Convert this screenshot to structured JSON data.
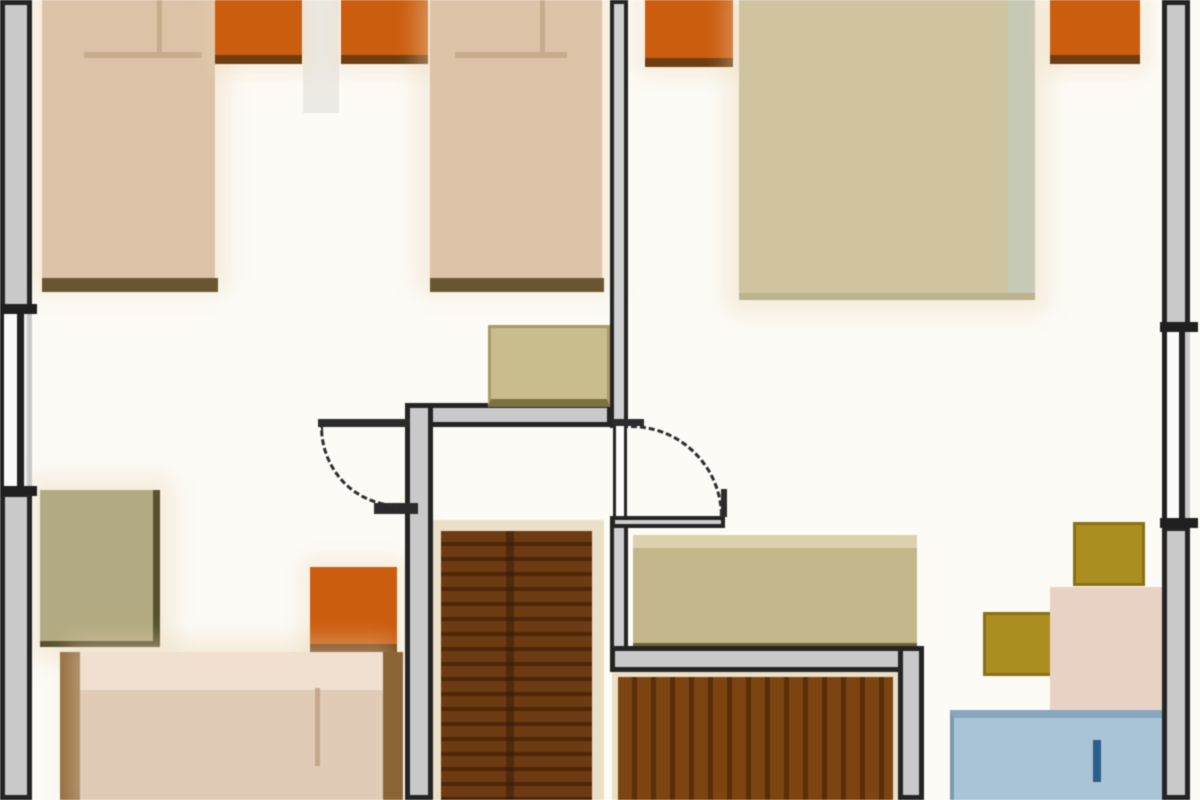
{
  "meta": {
    "diagram_type": "architectural-floor-plan",
    "canvas": {
      "width": 1200,
      "height": 800
    },
    "background": "#fcfbf6"
  },
  "palette": {
    "wall_fill": "#c9c9c9",
    "wall_line": "#242424",
    "bed_tan": "#dcc2a5",
    "bed_foot_brown": "#6a5532",
    "wardrobe_orange": "#cd5d0d",
    "double_bed_khaki": "#cfc39f",
    "stair_brown": "#6e3b11",
    "stair_brown_2": "#7c440f",
    "desk_olive": "#b2aa81",
    "sideboard_khaki": "#c2b689",
    "chair_gold": "#ac8d1e",
    "table_pink": "#e8d2c4",
    "blue_furniture": "#a9c3d8"
  },
  "elements": [
    {
      "name": "room-divider-faint",
      "cls": "faint",
      "rect": [
        303,
        0,
        36,
        113
      ]
    },
    {
      "name": "bed-single-1-mattress",
      "cls": "shadowed",
      "rect": [
        42,
        0,
        173,
        280
      ],
      "color": "#dcc2a5"
    },
    {
      "name": "bed-single-1-footboard",
      "cls": "",
      "rect": [
        42,
        278,
        176,
        14
      ],
      "color": "#6a5532"
    },
    {
      "name": "bed-single-1-pillow-line",
      "cls": "",
      "rect": [
        84,
        52,
        118,
        6
      ],
      "color": "#c7ab8c"
    },
    {
      "name": "bed-single-1-pillow-fold",
      "cls": "",
      "rect": [
        157,
        0,
        5,
        54
      ],
      "color": "#c7ab8c"
    },
    {
      "name": "wardrobe-1",
      "cls": "wardrobe",
      "rect": [
        215,
        0,
        87,
        64
      ]
    },
    {
      "name": "wardrobe-2",
      "cls": "wardrobe",
      "rect": [
        341,
        0,
        87,
        64
      ]
    },
    {
      "name": "bed-single-2-mattress",
      "cls": "shadowed",
      "rect": [
        430,
        0,
        172,
        280
      ],
      "color": "#dcc2a5"
    },
    {
      "name": "bed-single-2-footboard",
      "cls": "",
      "rect": [
        430,
        278,
        174,
        14
      ],
      "color": "#6a5532"
    },
    {
      "name": "bed-single-2-pillow-line",
      "cls": "",
      "rect": [
        455,
        52,
        112,
        6
      ],
      "color": "#c7ab8c"
    },
    {
      "name": "bed-single-2-pillow-fold",
      "cls": "",
      "rect": [
        540,
        0,
        5,
        54
      ],
      "color": "#c7ab8c"
    },
    {
      "name": "wardrobe-3",
      "cls": "wardrobe",
      "rect": [
        645,
        0,
        88,
        67
      ]
    },
    {
      "name": "bed-double",
      "cls": "shadowed bed-double",
      "rect": [
        739,
        0,
        296,
        300
      ],
      "color": "#cfc39f"
    },
    {
      "name": "bed-double-edge",
      "cls": "",
      "rect": [
        1008,
        0,
        27,
        293
      ],
      "color": "#c6c9b6"
    },
    {
      "name": "wardrobe-4",
      "cls": "wardrobe",
      "rect": [
        1050,
        0,
        90,
        64
      ]
    },
    {
      "name": "desk",
      "cls": "desk shadowed",
      "rect": [
        40,
        490,
        120,
        157
      ]
    },
    {
      "name": "cabinet-orange-small",
      "cls": "wardrobe",
      "rect": [
        310,
        567,
        87,
        86
      ]
    },
    {
      "name": "bed-3-rail-left",
      "cls": "",
      "rect": [
        60,
        652,
        20,
        148
      ],
      "color": "#8d6536"
    },
    {
      "name": "bed-3-mattress",
      "cls": "shadowed",
      "rect": [
        80,
        652,
        303,
        148
      ],
      "color": "#e0cbb6"
    },
    {
      "name": "bed-3-pillow-band",
      "cls": "",
      "rect": [
        80,
        652,
        303,
        38
      ],
      "color": "#efe0d0"
    },
    {
      "name": "bed-3-crease",
      "cls": "",
      "rect": [
        315,
        688,
        5,
        78
      ],
      "color": "#c8a78a"
    },
    {
      "name": "bed-3-rail-right",
      "cls": "",
      "rect": [
        383,
        652,
        20,
        148
      ],
      "color": "#8d6536"
    },
    {
      "name": "staircase-1-frame",
      "cls": "stairs-frame",
      "rect": [
        433,
        520,
        171,
        280
      ]
    },
    {
      "name": "staircase-1-treads",
      "cls": "stairs-treads-h",
      "rect": [
        441,
        531,
        151,
        269
      ]
    },
    {
      "name": "staircase-1-stringer",
      "cls": "stairs-crack",
      "rect": [
        506,
        531,
        8,
        269
      ]
    },
    {
      "name": "sideboard",
      "cls": "sideboard",
      "rect": [
        633,
        535,
        284,
        112
      ]
    },
    {
      "name": "staircase-2-frame",
      "cls": "stairs-frame",
      "rect": [
        612,
        670,
        286,
        130
      ]
    },
    {
      "name": "staircase-2-treads",
      "cls": "stairs-treads-v",
      "rect": [
        618,
        677,
        275,
        123
      ]
    },
    {
      "name": "chair-stool-1",
      "cls": "chair",
      "rect": [
        983,
        612,
        74,
        64
      ]
    },
    {
      "name": "chair-stool-2",
      "cls": "chair",
      "rect": [
        1073,
        522,
        72,
        64
      ]
    },
    {
      "name": "table-pink",
      "cls": "",
      "rect": [
        1050,
        587,
        112,
        123
      ],
      "color": "#e8d2c4"
    },
    {
      "name": "blue-furniture",
      "cls": "blue-item",
      "rect": [
        950,
        710,
        213,
        90
      ]
    },
    {
      "name": "blue-furniture-handle",
      "cls": "",
      "rect": [
        1093,
        740,
        8,
        42
      ],
      "color": "#2d5e8b"
    },
    {
      "name": "wall-left-top",
      "cls": "wall",
      "rect": [
        0,
        0,
        32,
        310
      ]
    },
    {
      "name": "window-left",
      "cls": "window-left",
      "rect": [
        0,
        310,
        32,
        182
      ]
    },
    {
      "name": "wall-left-bottom",
      "cls": "wall",
      "rect": [
        0,
        492,
        32,
        308
      ]
    },
    {
      "name": "window-left-tick-top",
      "cls": "wall-tick",
      "rect": [
        0,
        304,
        37,
        10
      ]
    },
    {
      "name": "window-left-tick-bottom",
      "cls": "wall-tick",
      "rect": [
        0,
        486,
        37,
        10
      ]
    },
    {
      "name": "wall-right-top",
      "cls": "wall",
      "rect": [
        1162,
        0,
        28,
        328
      ]
    },
    {
      "name": "window-right",
      "cls": "window-right",
      "rect": [
        1162,
        328,
        28,
        198
      ]
    },
    {
      "name": "wall-right-bottom",
      "cls": "wall",
      "rect": [
        1162,
        526,
        28,
        274
      ]
    },
    {
      "name": "window-right-tick-top",
      "cls": "wall-tick",
      "rect": [
        1160,
        322,
        38,
        10
      ]
    },
    {
      "name": "window-right-tick-bottom",
      "cls": "wall-tick",
      "rect": [
        1160,
        518,
        38,
        10
      ]
    },
    {
      "name": "wall-center-upper",
      "cls": "wall-thin",
      "rect": [
        610,
        0,
        18,
        428
      ]
    },
    {
      "name": "wall-center-lower",
      "cls": "wall-thin",
      "rect": [
        610,
        516,
        18,
        150
      ]
    },
    {
      "name": "wall-door-right-sill",
      "cls": "wall-thin",
      "rect": [
        611,
        516,
        114,
        12
      ]
    },
    {
      "name": "door-right-jamb-top",
      "cls": "wall-solid",
      "rect": [
        612,
        419,
        32,
        7
      ]
    },
    {
      "name": "door-right-jamb-end",
      "cls": "wall-solid",
      "rect": [
        721,
        489,
        6,
        28
      ]
    },
    {
      "name": "wall-hall-top",
      "cls": "wall",
      "rect": [
        405,
        403,
        207,
        24
      ]
    },
    {
      "name": "wall-hall-left",
      "cls": "wall",
      "rect": [
        405,
        403,
        28,
        397
      ]
    },
    {
      "name": "door-left-stub",
      "cls": "wall-solid",
      "rect": [
        374,
        503,
        44,
        11
      ]
    },
    {
      "name": "wall-stairwell2-top",
      "cls": "wall",
      "rect": [
        610,
        646,
        312,
        26
      ]
    },
    {
      "name": "wall-stairwell2-right",
      "cls": "wall",
      "rect": [
        898,
        646,
        26,
        154
      ]
    },
    {
      "name": "hall-cabinet",
      "cls": "hallcab",
      "rect": [
        488,
        325,
        122,
        82
      ]
    },
    {
      "name": "door-leaf-right",
      "cls": "door-leaf-v",
      "rect": [
        613,
        426,
        14,
        90
      ]
    },
    {
      "name": "door-arc-right",
      "cls": "door-arc-ne",
      "rect": [
        631,
        425,
        92,
        92
      ]
    },
    {
      "name": "door-leaf-left",
      "cls": "wall-solid",
      "rect": [
        318,
        419,
        92,
        8
      ]
    },
    {
      "name": "door-arc-left",
      "cls": "door-arc-sw",
      "rect": [
        320,
        427,
        78,
        80
      ]
    }
  ]
}
